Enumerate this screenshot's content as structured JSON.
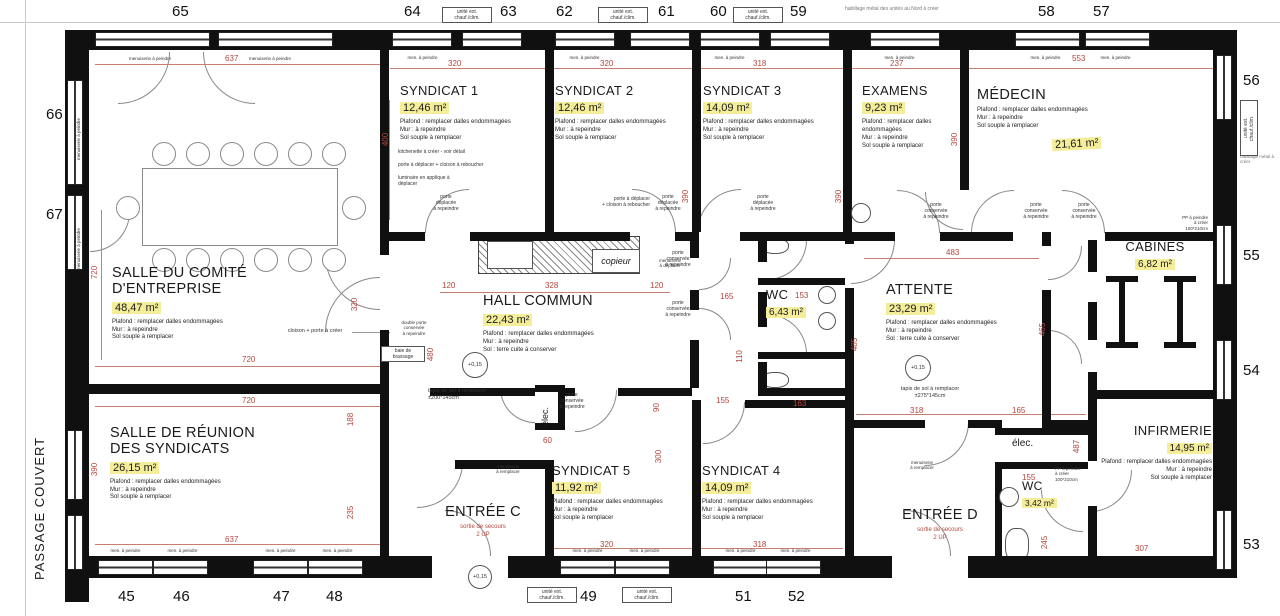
{
  "grid": {
    "top": [
      "65",
      "64",
      "63",
      "62",
      "61",
      "60",
      "59",
      "58",
      "57"
    ],
    "bottom": [
      "45",
      "46",
      "47",
      "48",
      "49",
      "50",
      "51",
      "52"
    ],
    "left": [
      "66",
      "67"
    ],
    "right": [
      "56",
      "55",
      "54",
      "53"
    ]
  },
  "rooms": {
    "comite": {
      "name": "SALLE DU COMITÉ\nD'ENTREPRISE",
      "area": "48,47 m²",
      "notes": "Plafond : remplacer dalles endommagées\nMur : à repeindre\nSol souple à remplacer"
    },
    "reunion": {
      "name": "SALLE DE RÉUNION\nDES SYNDICATS",
      "area": "26,15 m²",
      "notes": "Plafond : remplacer dalles endommagées\nMur : à repeindre\nSol souple à remplacer"
    },
    "syndicat1": {
      "name": "SYNDICAT 1",
      "area": "12,46 m²",
      "notes": "Plafond : remplacer dalles endommagées\nMur : à repeindre\nSol souple à remplacer"
    },
    "syndicat2": {
      "name": "SYNDICAT 2",
      "area": "12,46 m²",
      "notes": "Plafond : remplacer dalles endommagées\nMur : à repeindre\nSol souple à remplacer"
    },
    "syndicat3": {
      "name": "SYNDICAT 3",
      "area": "14,09 m²",
      "notes": "Plafond : remplacer dalles endommagées\nMur : à repeindre\nSol souple à remplacer"
    },
    "examens": {
      "name": "EXAMENS",
      "area": "9,23 m²",
      "notes": "Plafond : remplacer dalles\nendommagées\nMur : à repeindre\nSol souple à remplacer"
    },
    "medecin": {
      "name": "MÉDECIN",
      "area": "21,61 m²",
      "notes": "Plafond : remplacer dalles endommagées\nMur : à repeindre\nSol souple à remplacer"
    },
    "hall": {
      "name": "HALL COMMUN",
      "area": "22,43 m²",
      "notes": "Plafond : remplacer dalles endommagées\nMur : à repeindre\nSol : terre cuite à conserver"
    },
    "wc1": {
      "name": "WC",
      "area": "6,43 m²"
    },
    "attente": {
      "name": "ATTENTE",
      "area": "23,29 m²",
      "notes": "Plafond : remplacer dalles endommagées\nMur : à repeindre\nSol : terre cuite à conserver"
    },
    "cabines": {
      "name": "CABINES",
      "area": "6,82 m²"
    },
    "syndicat5": {
      "name": "SYNDICAT 5",
      "area": "11,92 m²",
      "notes": "Plafond : remplacer dalles endommagées\nMur : à repeindre\nSol souple à remplacer"
    },
    "syndicat4": {
      "name": "SYNDICAT 4",
      "area": "14,09 m²",
      "notes": "Plafond : remplacer dalles endommagées\nMur : à repeindre\nSol souple à remplacer"
    },
    "entreeC": {
      "name": "ENTRÉE C",
      "sub": "sortie de secours\n2 UP"
    },
    "entreeD": {
      "name": "ENTRÉE D",
      "sub": "sortie de secours\n2 UP"
    },
    "infirmerie": {
      "name": "INFIRMERIE",
      "area": "14,95 m²",
      "notes": "Plafond : remplacer dalles endommagées\nMur : à repeindre\nSol souple à remplacer"
    },
    "wc2": {
      "name": "WC",
      "area": "3,42 m²"
    },
    "elec": {
      "name": "élec."
    }
  },
  "ann": {
    "passage": "PASSAGE COUVERT",
    "unite": "unité ext.\nchauf./clim.",
    "habillage": "habillage métal des unités au Nord à créer",
    "habillage_right": "habillage métal à créer",
    "men": "men. à peindre",
    "menuiserie": "menuiserie à peindre",
    "menuiserie_remp": "menuiserie\nà remplacer",
    "porte_cons": "porte\nconservée\nà repeindre",
    "porte_depl": "porte\ndéplacée\nà repeindre",
    "porte_deplacer1": "porte à déplacer + cloison à reboucher",
    "porte_deplacer2": "porte à déplacer\n+ cloison à reboucher",
    "kitchenette": "kitchenette à créer - voir détail",
    "luminaire": "luminaire en applique à\ndéplacer",
    "cloison_porte": "cloison + porte à créer",
    "double_porte": "double porte\nconservée\nà repeindre",
    "baie": "baie de\nbrassage",
    "copieur": "copieur",
    "tapis200": "tapis de sol à remplacer\n±200*145cm",
    "tapis275": "tapis de sol à remplacer\n±275*145cm",
    "niveau": "+0,15",
    "pp": "PP à peindre\nà créer\n100*210cm",
    "sortie": "sortie de secours\n2 UP",
    "menuiserie_depl": "menuiserie\nà déplacer"
  },
  "dims": [
    "637",
    "320",
    "320",
    "318",
    "237",
    "553",
    "400",
    "390",
    "390",
    "390",
    "720",
    "720",
    "720",
    "320",
    "390",
    "188",
    "235",
    "637",
    "120",
    "328",
    "120",
    "480",
    "165",
    "153",
    "110",
    "163",
    "155",
    "483",
    "485",
    "465",
    "318",
    "165",
    "487",
    "155",
    "307",
    "60",
    "90",
    "300",
    "320",
    "318",
    "245"
  ]
}
